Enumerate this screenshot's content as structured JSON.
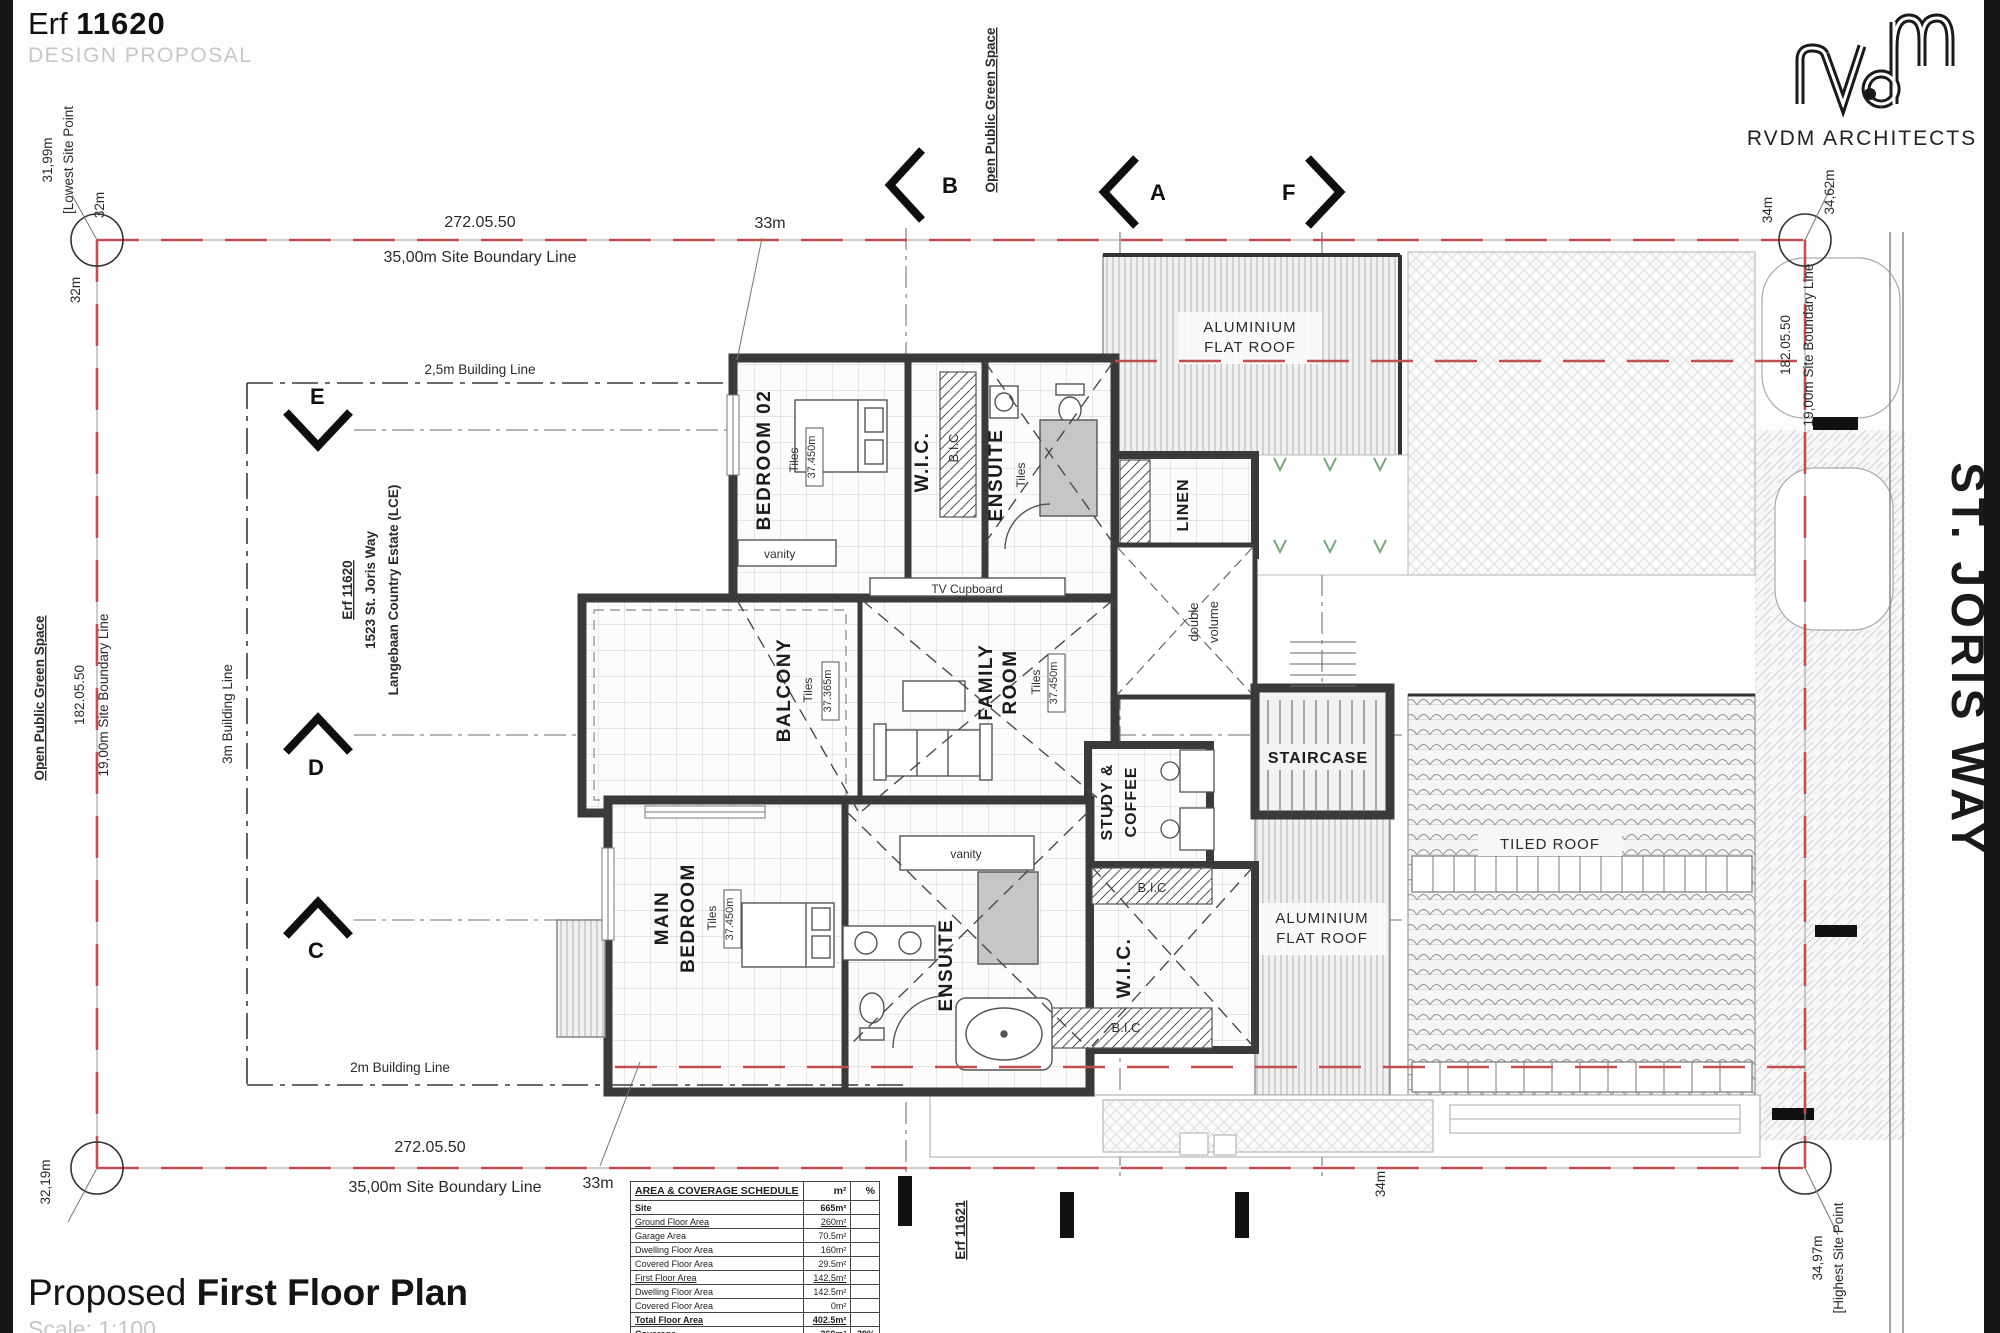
{
  "page": {
    "erf_label": "Erf",
    "erf_number": "11620",
    "subtitle": "DESIGN PROPOSAL",
    "brand": "RVDM ARCHITECTS",
    "title_light": "Proposed ",
    "title_bold": "First Floor Plan",
    "scale": "Scale: 1:100"
  },
  "site": {
    "lowest_val": "31,99m",
    "lowest_note": "[Lowest Site Point",
    "highest_val": "34,97m",
    "highest_note": "[Highest Site Point",
    "corner_32a": "32m",
    "corner_32b": "32m",
    "corner_3219": "32,19m",
    "corner_3462": "34,62m",
    "dim_34_top": "34m",
    "dim_34_bottom": "34m",
    "dim_33_top": "33m",
    "dim_33_bottom": "33m",
    "top_bearing": "272.05.50",
    "top_boundary": "35,00m Site Boundary Line",
    "bottom_bearing": "272.05.50",
    "bottom_boundary": "35,00m Site Boundary Line",
    "left_bearing": "182.05.50",
    "left_boundary": "19,00m Site Boundary Line",
    "right_bearing": "182.05.50",
    "right_boundary": "19,00m Site Boundary Line",
    "green_top": "Open Public Green Space",
    "green_left": "Open Public Green Space",
    "bl_25": "2,5m Building Line",
    "bl_3": "3m Building Line",
    "bl_2": "2m Building Line",
    "erf_line1": "Erf 11620",
    "erf_line2": "1523 St. Joris Way",
    "erf_line3": "Langebaan Country Estate (LCE)",
    "erf_neighbor": "Erf 11621",
    "street": "ST. JORIS WAY"
  },
  "markers": {
    "b": "B",
    "a": "A",
    "f": "F",
    "e": "E",
    "d": "D",
    "c": "C"
  },
  "rooms": {
    "bedroom02": "BEDROOM 02",
    "bedroom02_fin": "Tiles",
    "bedroom02_lvl": "37.450m",
    "wic_upper": "W.I.C.",
    "bic_upper": "B.I.C",
    "ensuite_upper": "ENSUITE",
    "ensuite_upper_fin": "Tiles",
    "vanity_upper": "vanity",
    "tv": "TV Cupboard",
    "linen": "LINEN",
    "dv1": "double",
    "dv2": "volume",
    "balcony": "BALCONY",
    "balcony_fin": "Tiles",
    "balcony_lvl": "37.365m",
    "family1": "FAMILY",
    "family2": "ROOM",
    "family_fin": "Tiles",
    "family_lvl": "37.450m",
    "staircase": "STAIRCASE",
    "study1": "STUDY &",
    "study2": "COFFEE",
    "main1": "MAIN",
    "main2": "BEDROOM",
    "main_fin": "Tiles",
    "main_lvl": "37.450m",
    "vanity_lower": "vanity",
    "ensuite_lower": "ENSUITE",
    "wic_lower": "W.I.C.",
    "bic_lower_top": "B.I.C",
    "bic_lower_bottom": "B.I.C",
    "flat_roof_top1": "ALUMINIUM",
    "flat_roof_top2": "FLAT ROOF",
    "flat_roof_low1": "ALUMINIUM",
    "flat_roof_low2": "FLAT ROOF",
    "tiled_roof": "TILED ROOF"
  },
  "schedule": {
    "title": "AREA & COVERAGE SCHEDULE",
    "col_m2": "m²",
    "col_pct": "%",
    "rows": [
      {
        "label": "Site",
        "m2": "665m²",
        "pct": ""
      },
      {
        "label": "Ground Floor Area",
        "m2": "260m²",
        "pct": ""
      },
      {
        "label": "Garage Area",
        "m2": "70.5m²",
        "pct": ""
      },
      {
        "label": "Dwelling Floor Area",
        "m2": "160m²",
        "pct": ""
      },
      {
        "label": "Covered Floor Area",
        "m2": "29.5m²",
        "pct": ""
      },
      {
        "label": "First Floor Area",
        "m2": "142.5m²",
        "pct": ""
      },
      {
        "label": "Dwelling Floor Area",
        "m2": "142.5m²",
        "pct": ""
      },
      {
        "label": "Covered Floor Area",
        "m2": "0m²",
        "pct": ""
      },
      {
        "label": "Total Floor Area",
        "m2": "402.5m²",
        "pct": ""
      },
      {
        "label": "Coverage",
        "m2": "260m²",
        "pct": "39%"
      }
    ]
  }
}
